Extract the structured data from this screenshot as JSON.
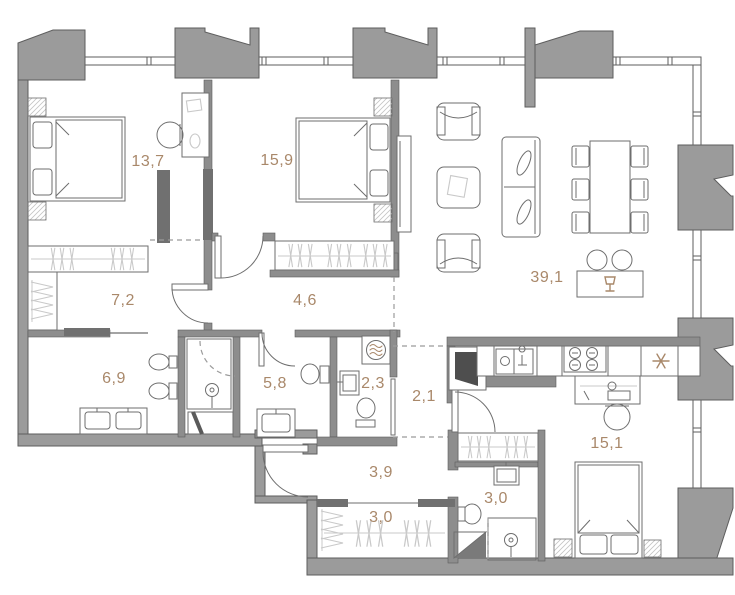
{
  "plan": {
    "colors": {
      "label": "#a9886a",
      "wall-fill": "#9b9b9b",
      "wall-stroke": "#5e5e5e",
      "inner-wall": "#8d8d8d",
      "dark-bar": "#707070",
      "furniture-line": "#6e6e6e",
      "light-line": "#c9c9c9",
      "dash": "#9b9b9b"
    },
    "rooms": [
      {
        "key": "bedroom-1",
        "label": "13,7"
      },
      {
        "key": "bedroom-2",
        "label": "15,9"
      },
      {
        "key": "living-dining-kitchen",
        "label": "39,1"
      },
      {
        "key": "walk-in-closet",
        "label": "7,2"
      },
      {
        "key": "hallway",
        "label": "4,6"
      },
      {
        "key": "bathroom-1",
        "label": "6,9"
      },
      {
        "key": "bathroom-2",
        "label": "5,8"
      },
      {
        "key": "laundry-wc",
        "label": "2,3"
      },
      {
        "key": "corridor-1",
        "label": "2,1"
      },
      {
        "key": "corridor-2",
        "label": "3,9"
      },
      {
        "key": "closet",
        "label": "3,0"
      },
      {
        "key": "bathroom-3",
        "label": "3,0"
      },
      {
        "key": "bedroom-3",
        "label": "15,1"
      }
    ],
    "icons": {
      "fridge": "snowflake-asterisk",
      "bar": "wine-glass",
      "washing_machine": "drum-with-waves",
      "shower": "shower-head-spiral",
      "wardrobe": "clothes-hangers"
    }
  }
}
